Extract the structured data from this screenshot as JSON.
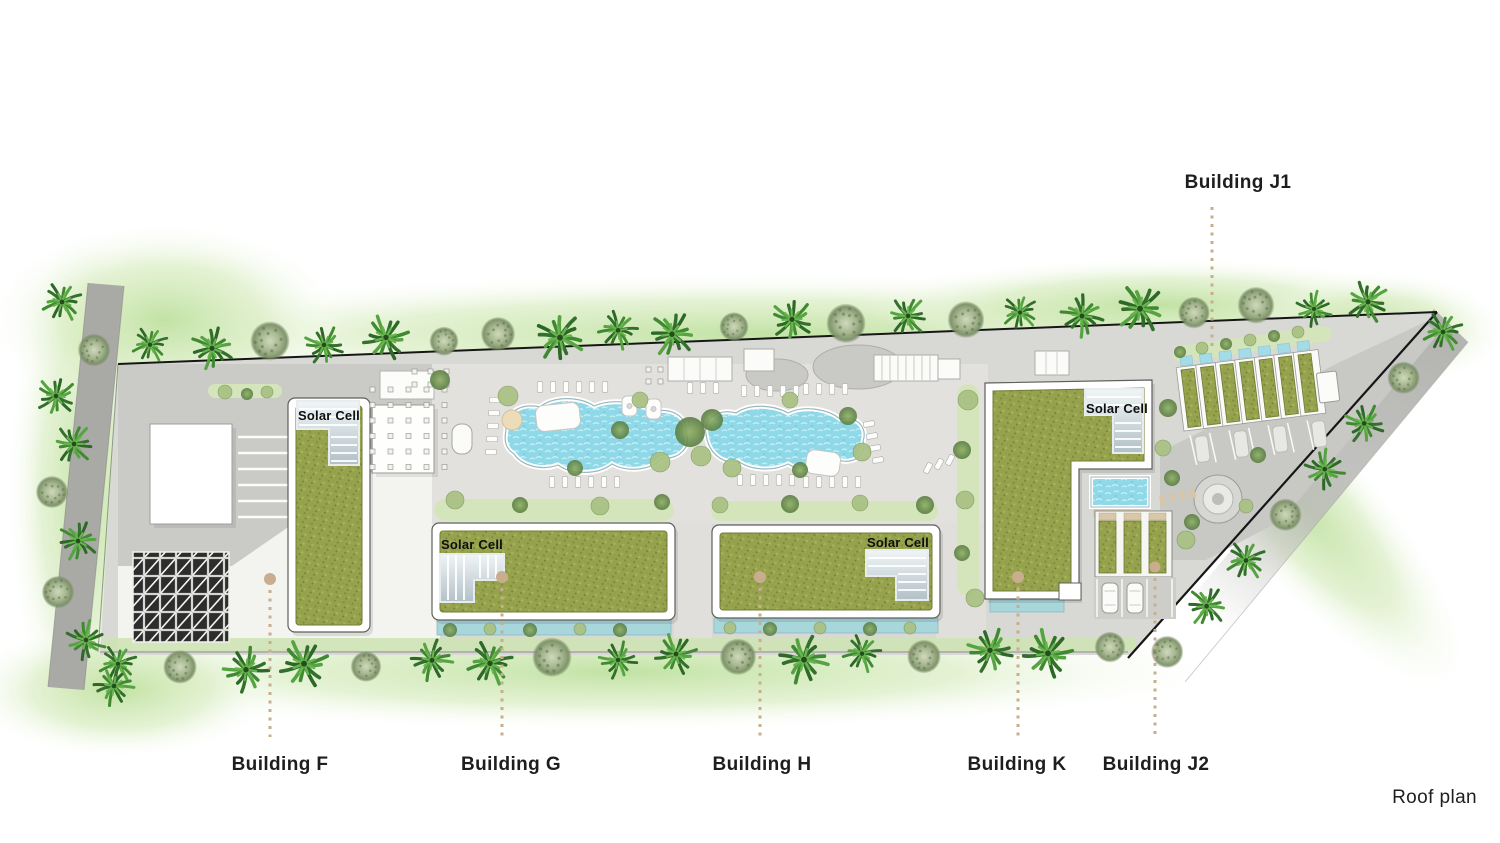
{
  "view": {
    "name": "Roof plan"
  },
  "buildings": {
    "f": {
      "label": "Building F"
    },
    "g": {
      "label": "Building G"
    },
    "h": {
      "label": "Building H"
    },
    "k": {
      "label": "Building K"
    },
    "j1": {
      "label": "Building J1"
    },
    "j2": {
      "label": "Building J2"
    }
  },
  "annotations": {
    "solar_cell": "Solar Cell"
  },
  "colors": {
    "roof_green": "#96a24d",
    "pool_water": "#8ed8e8",
    "canal_water": "#a7d6db",
    "ground": "#d8d8d4",
    "road": "#a9a9a6",
    "palm_green": "#3f8a31",
    "halo_green": "#c6e4a4",
    "leader_tan": "#c9ae8d",
    "label_text": "#1e1e1e",
    "solar_panel": "#c3d0d6",
    "trellis_dark": "#2d2d2d"
  }
}
